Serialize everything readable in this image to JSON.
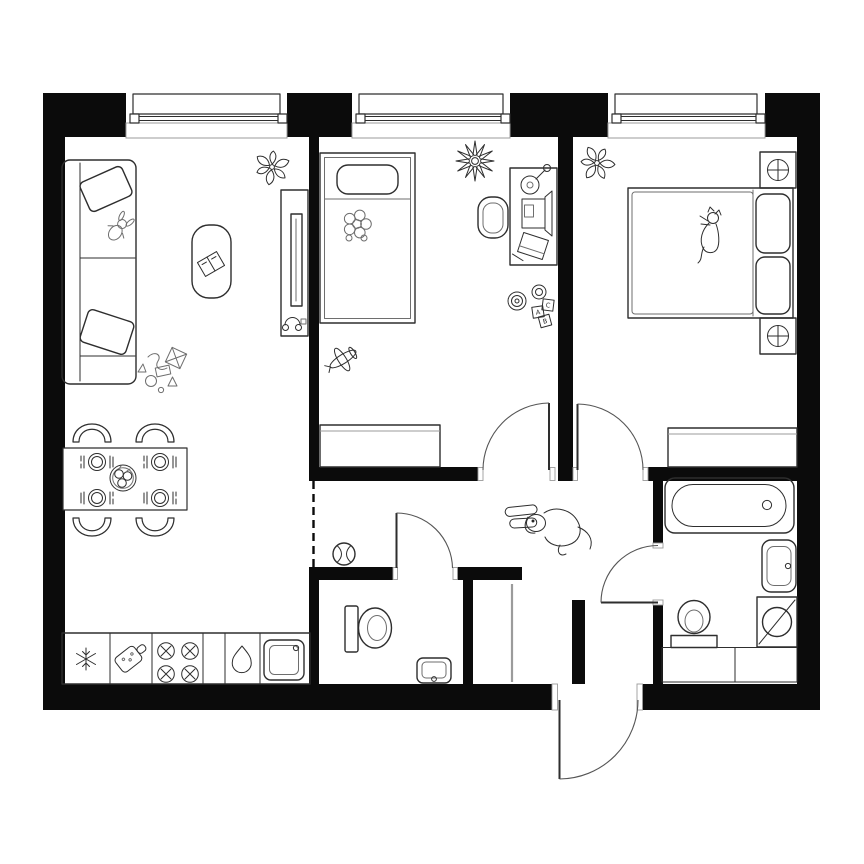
{
  "meta": {
    "title": "Two-bedroom apartment floor plan",
    "type": "architectural-floor-plan",
    "view": "top-down",
    "style": "black and white line drawing"
  },
  "colors": {
    "bg": "#ffffff",
    "wall": "#0b0b0b",
    "line": "#2e2e2e",
    "soft": "#6e6e6e",
    "lite": "#9b9b9b",
    "arc": "#555555"
  },
  "windows": {
    "count": 3,
    "locations": [
      "living-room-top",
      "kids-room-top",
      "master-bedroom-top"
    ]
  },
  "doors": {
    "interior_swing": 4,
    "entrance_swing": 1,
    "open_passages": 2
  },
  "rooms": [
    {
      "id": "living-kitchen",
      "label": "Living room with kitchen",
      "furniture": [
        "corner sofa with two pillows",
        "toy bunny",
        "coffee table with book",
        "potted plant",
        "tv console with tv and headphones",
        "toy pile",
        "dining table for four",
        "four chairs",
        "four place settings",
        "fruit bowl",
        "fridge",
        "cutting board",
        "four-burner stove",
        "water drop sink",
        "kitchen sink"
      ]
    },
    {
      "id": "kids-bedroom",
      "label": "Kids bedroom",
      "furniture": [
        "single bed with pillow",
        "plush flower",
        "star plant",
        "desk",
        "desk chair",
        "monitor",
        "joystick toy",
        "paper sheet",
        "ring pyramid toy",
        "letter blocks",
        "toy plane",
        "wardrobe"
      ]
    },
    {
      "id": "master-bedroom",
      "label": "Master bedroom",
      "furniture": [
        "double bed with two pillows",
        "cat",
        "two nightstands with lamps",
        "potted plant",
        "wardrobe"
      ]
    },
    {
      "id": "bathroom",
      "label": "Bathroom",
      "furniture": [
        "bathtub",
        "washbasin",
        "washing machine",
        "toilet",
        "cabinets"
      ]
    },
    {
      "id": "wc",
      "label": "WC",
      "furniture": [
        "toilet",
        "small washbasin"
      ]
    },
    {
      "id": "hallway",
      "label": "Hallway",
      "furniture": [
        "dog",
        "ball"
      ]
    },
    {
      "id": "closet",
      "label": "Storage closet",
      "furniture": []
    }
  ],
  "toy_blocks": {
    "letters": [
      "A",
      "C",
      "B"
    ]
  }
}
